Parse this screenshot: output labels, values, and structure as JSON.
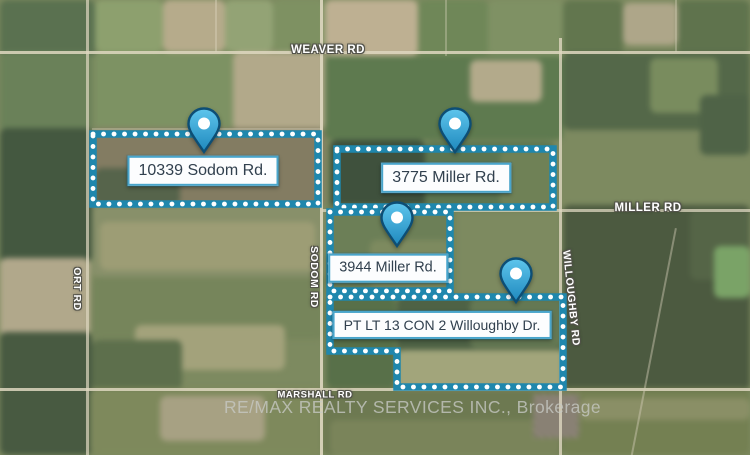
{
  "watermark": "RE/MAX REALTY SERVICES INC., Brokerage",
  "colors": {
    "boundary_band": "#1f87ad",
    "boundary_dots": "#ffffff",
    "pin_fill_top": "#5ec5ec",
    "pin_fill_bottom": "#1e88bd",
    "pin_stroke": "#0d4e75",
    "label_border": "#49a5cb",
    "label_text": "#31404e"
  },
  "parcels": [
    {
      "id": "10339-sodom-rd",
      "points": "93,134 318,134 318,204 93,204",
      "pin": {
        "x": 204,
        "y": 153
      },
      "label": {
        "text": "10339 Sodom Rd.",
        "cx": 203,
        "cy": 171,
        "size": 16
      }
    },
    {
      "id": "3775-miller-rd",
      "points": "337,149 553,149 553,207 337,207",
      "pin": {
        "x": 455,
        "y": 153
      },
      "label": {
        "text": "3775 Miller Rd.",
        "cx": 446,
        "cy": 178,
        "size": 16
      }
    },
    {
      "id": "3944-miller-rd",
      "points": "330,212 450,212 450,291 330,291",
      "pin": {
        "x": 397,
        "y": 247
      },
      "label": {
        "text": "3944 Miller Rd.",
        "cx": 388,
        "cy": 268,
        "size": 14.5
      }
    },
    {
      "id": "pt-lt-13-con-2-willoughby-dr",
      "points": "330,297 563,297 563,387 397,387 397,351 330,351",
      "pin": {
        "x": 516,
        "y": 303
      },
      "label": {
        "text": "PT LT 13 CON 2 Willoughby Dr.",
        "cx": 442,
        "cy": 325,
        "size": 14
      }
    }
  ],
  "road_labels": [
    {
      "text": "WEAVER RD",
      "cx": 328,
      "cy": 50,
      "rotate": 0,
      "size": 11.5
    },
    {
      "text": "MILLER RD",
      "cx": 648,
      "cy": 208,
      "rotate": 0,
      "size": 11.5
    },
    {
      "text": "MARSHALL RD",
      "cx": 315,
      "cy": 395,
      "rotate": 0,
      "size": 9.5
    },
    {
      "text": "SODOM RD",
      "cx": 314,
      "cy": 277,
      "rotate": 90,
      "size": 10.5
    },
    {
      "text": "WILLOUGHBY RD",
      "cx": 571,
      "cy": 298,
      "rotate": 84,
      "size": 10.5
    },
    {
      "text": "ORT RD",
      "cx": 77,
      "cy": 289,
      "rotate": 90,
      "size": 10.5
    }
  ]
}
